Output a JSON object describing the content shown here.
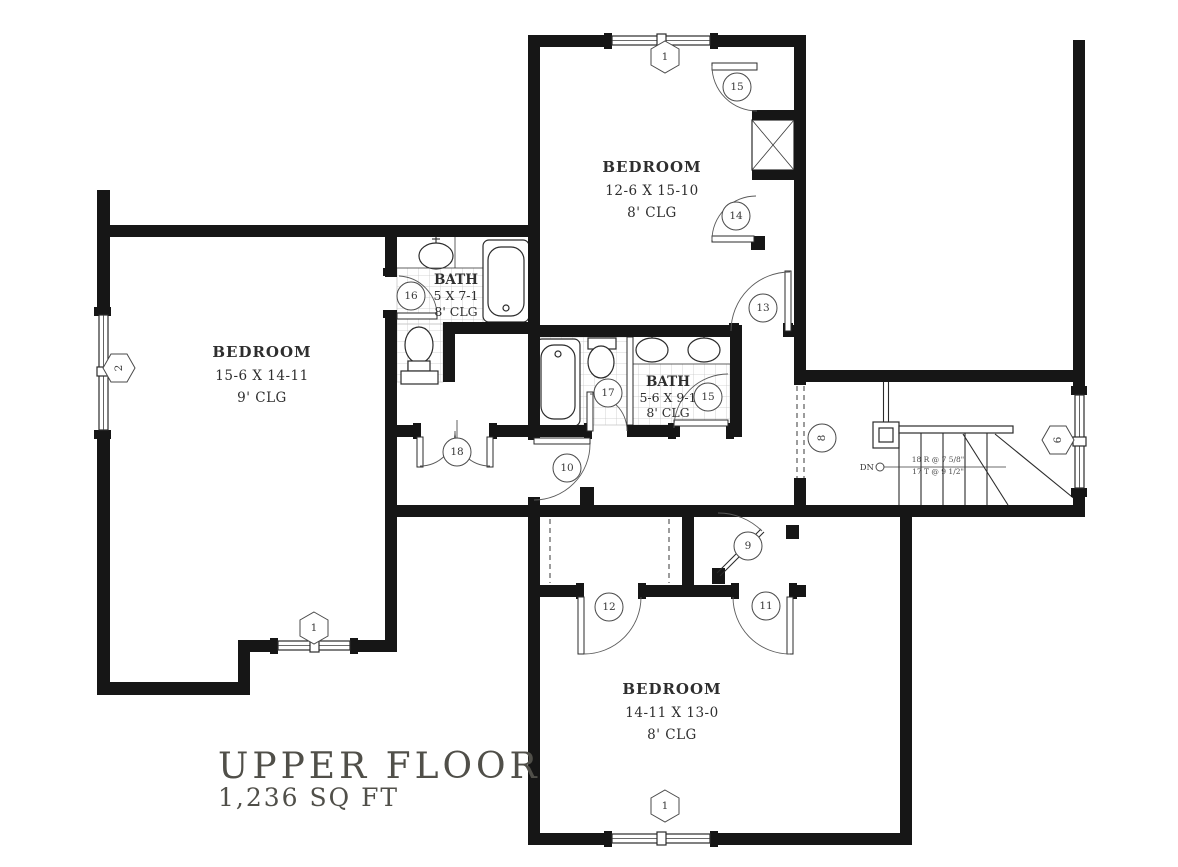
{
  "title": {
    "line1": "UPPER FLOOR",
    "line2": "1,236 SQ FT"
  },
  "rooms": [
    {
      "id": "bedroom-upper",
      "name": "BEDROOM",
      "dims": "12-6 X 15-10",
      "ceiling": "8' CLG"
    },
    {
      "id": "bedroom-left",
      "name": "BEDROOM",
      "dims": "15-6 X 14-11",
      "ceiling": "9' CLG"
    },
    {
      "id": "bedroom-lower",
      "name": "BEDROOM",
      "dims": "14-11 X 13-0",
      "ceiling": "8' CLG"
    },
    {
      "id": "bath-upper",
      "name": "BATH",
      "dims": "5 X 7-1",
      "ceiling": "8' CLG"
    },
    {
      "id": "bath-middle",
      "name": "BATH",
      "dims": "5-6 X 9-1",
      "ceiling": "8' CLG"
    }
  ],
  "stairs": {
    "direction": "DN",
    "riser_note": "18 R @ 7 5/8\"",
    "tread_note": "17 T @ 9 1/2\""
  },
  "window_markers": [
    "1",
    "2",
    "1",
    "1",
    "6"
  ],
  "door_markers": [
    "15",
    "14",
    "13",
    "16",
    "17",
    "15",
    "10",
    "18",
    "12",
    "11",
    "9",
    "8"
  ],
  "colors": {
    "wall": "#161616",
    "tile_grid": "#c8c8c8",
    "text": "#2e2e2e",
    "title": "#504f49"
  }
}
